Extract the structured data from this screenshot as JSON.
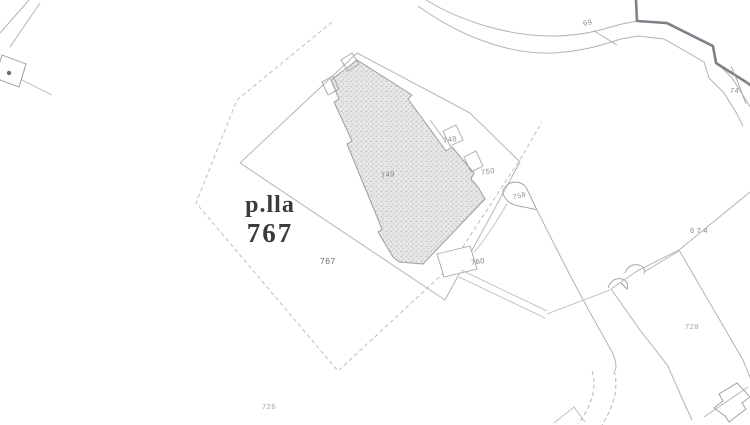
{
  "map": {
    "primary_parcel_label": {
      "prefix": "p.lla",
      "number": "767"
    },
    "parcel_labels": [
      {
        "id": "subparcel-767",
        "text": "767"
      },
      {
        "id": "building-749",
        "text": "749"
      },
      {
        "id": "annex-748",
        "text": "748"
      },
      {
        "id": "right-750",
        "text": "750"
      },
      {
        "id": "flag-758",
        "text": "758"
      },
      {
        "id": "annex-760",
        "text": "760"
      },
      {
        "id": "parcel-674",
        "text": "674"
      },
      {
        "id": "parcel-728",
        "text": "728"
      },
      {
        "id": "parcel-726",
        "text": "726"
      },
      {
        "id": "road-69",
        "text": "69"
      },
      {
        "id": "road-74",
        "text": "74"
      }
    ],
    "colors": {
      "background": "#ffffff",
      "line": "#b4b4b4",
      "line_dark_boundary": "#70757d",
      "building_fill_base": "#e7e7e7",
      "building_stipple": "#b9b9b9",
      "main_label_text": "#3b3b3b",
      "small_label_text": "#8e8e8e"
    }
  }
}
